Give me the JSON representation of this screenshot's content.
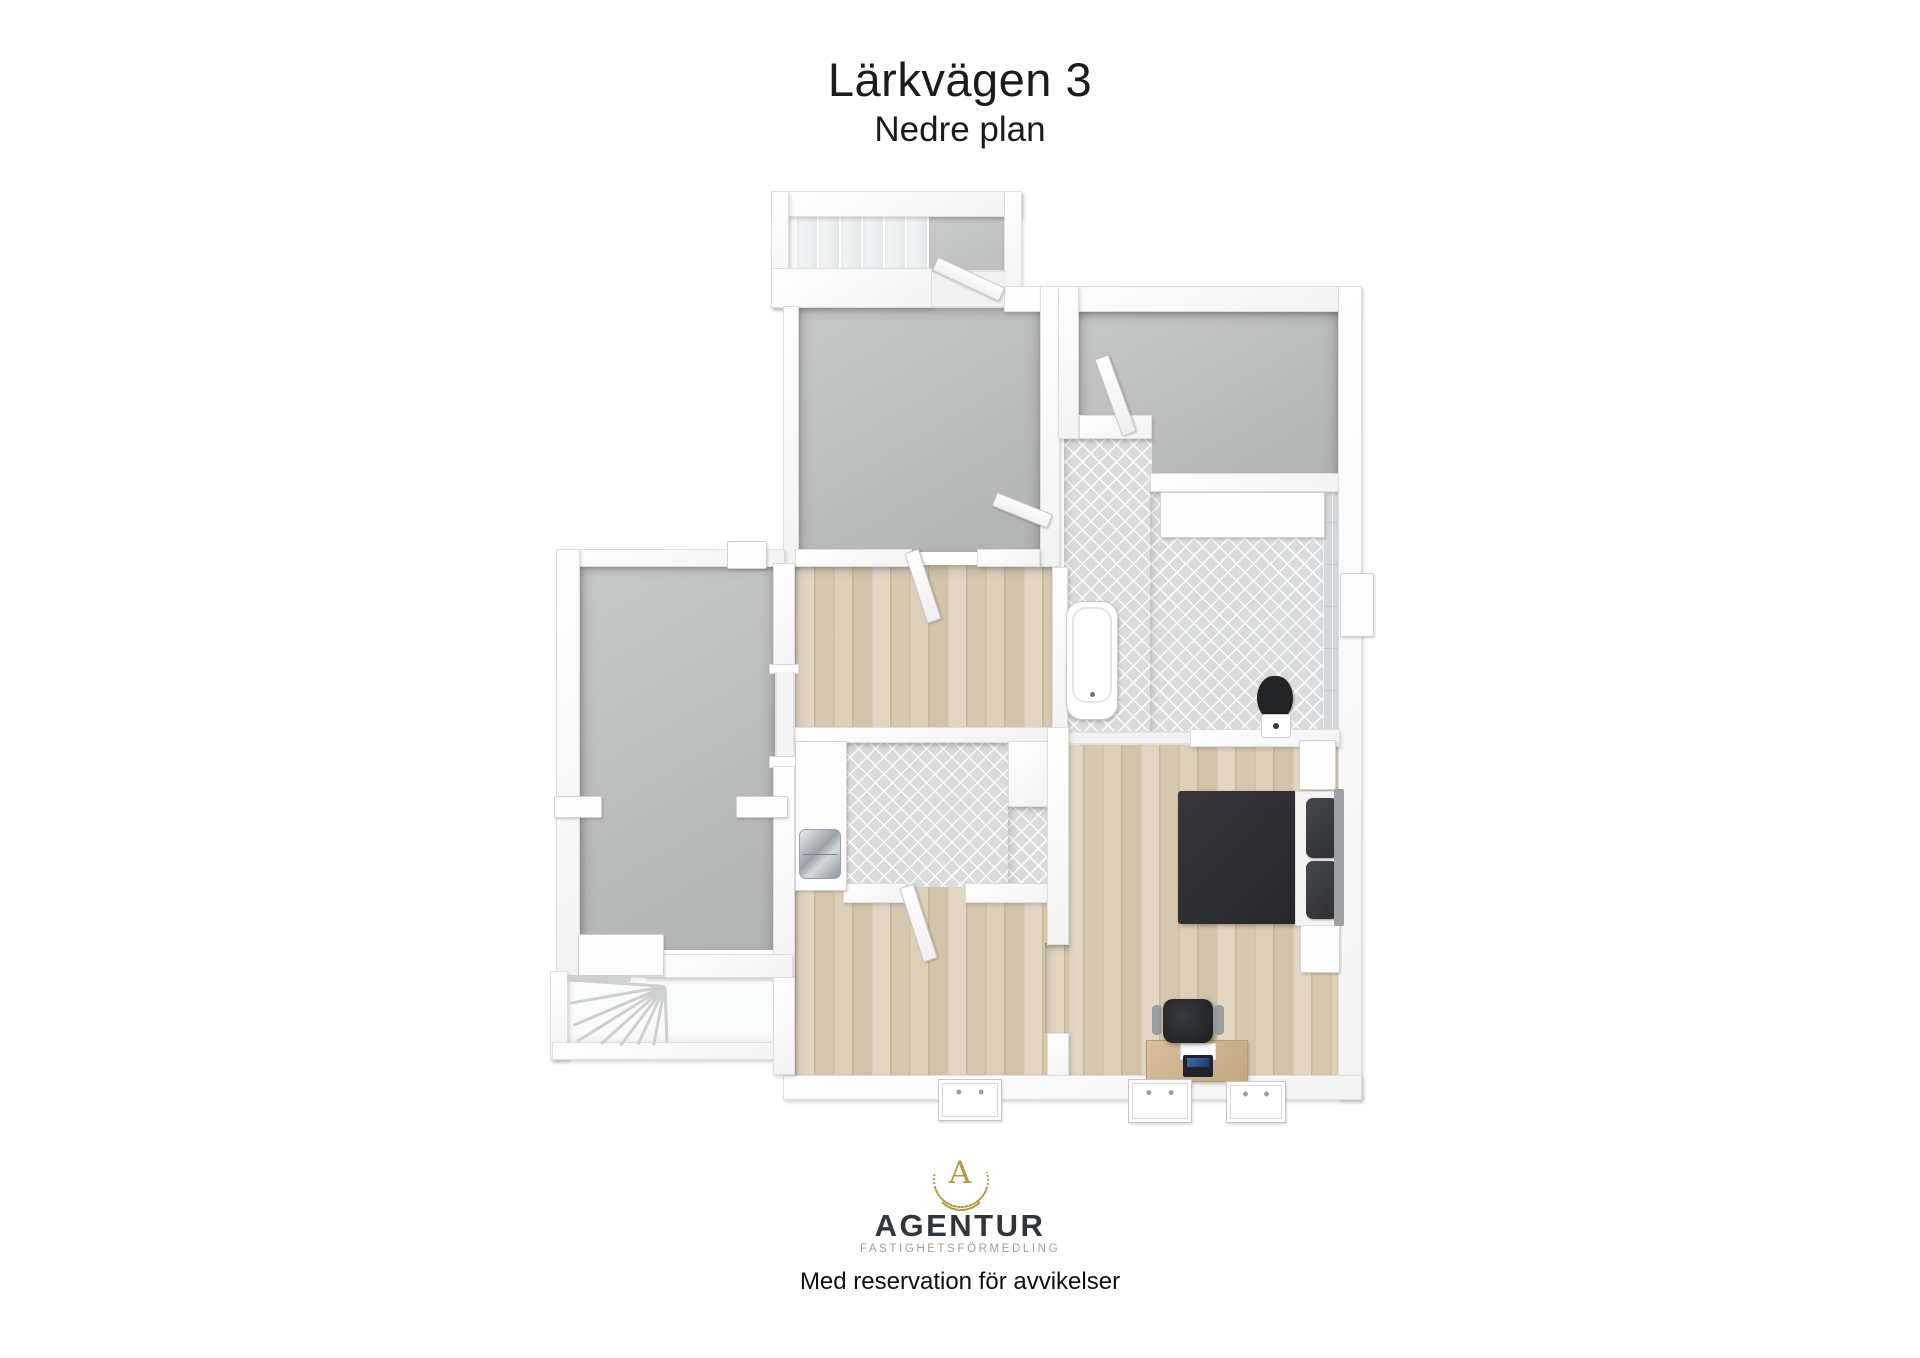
{
  "header": {
    "title": "Lärkvägen 3",
    "subtitle": "Nedre plan"
  },
  "footer": {
    "logo_monogram": "A",
    "brand": "AGENTUR",
    "brand_subtitle": "FASTIGHETSFÖRMEDLING",
    "disclaimer": "Med reservation för avvikelser"
  },
  "colors": {
    "accent_gold": "#b6983f",
    "wall_white": "#ffffff",
    "floor_gray": "#b9bbba",
    "floor_wood": "#dbceb6",
    "floor_tile": "#d9dbdd",
    "furniture_dark": "#2c2d2f",
    "text_dark": "#1b1b1b"
  },
  "plan": {
    "label": "3D floor plan, lower level",
    "elements": [
      {
        "n": "stairwell-top-floor",
        "t": "stairwell",
        "x": 787,
        "y": 205,
        "w": 143,
        "h": 70
      },
      {
        "n": "stair-landing-floor",
        "t": "floor-gray2",
        "x": 928,
        "y": 213,
        "w": 80,
        "h": 62
      },
      {
        "n": "room-top-middle-floor",
        "t": "floor-gray",
        "x": 797,
        "y": 306,
        "w": 243,
        "h": 246
      },
      {
        "n": "room-top-right-floor",
        "t": "floor-gray",
        "x": 1077,
        "y": 311,
        "w": 261,
        "h": 166
      },
      {
        "n": "bathroom-lobe-floor",
        "t": "floor-tile",
        "x": 1064,
        "y": 437,
        "w": 88,
        "h": 296
      },
      {
        "n": "bathroom-main-floor",
        "t": "floor-tile",
        "x": 1150,
        "y": 490,
        "w": 173,
        "h": 243
      },
      {
        "n": "bathroom-wall-tiles",
        "t": "tile-wall",
        "x": 1323,
        "y": 490,
        "w": 17,
        "h": 243
      },
      {
        "n": "room-left-floor",
        "t": "floor-gray",
        "x": 580,
        "y": 563,
        "w": 195,
        "h": 387
      },
      {
        "n": "hallway-floor",
        "t": "floor-wood",
        "x": 795,
        "y": 565,
        "w": 257,
        "h": 165
      },
      {
        "n": "room-bottom-floor",
        "t": "floor-wood",
        "x": 795,
        "y": 730,
        "w": 254,
        "h": 345
      },
      {
        "n": "bedroom-floor",
        "t": "floor-wood",
        "x": 1064,
        "y": 733,
        "w": 276,
        "h": 342
      },
      {
        "n": "bedroom-doorway-floor",
        "t": "floor-wood",
        "x": 1045,
        "y": 943,
        "w": 24,
        "h": 90
      },
      {
        "n": "laundry-floor",
        "t": "floor-tile",
        "x": 843,
        "y": 741,
        "w": 167,
        "h": 146
      },
      {
        "n": "laundry-floor-ext",
        "t": "floor-tile",
        "x": 1008,
        "y": 805,
        "w": 44,
        "h": 82
      },
      {
        "n": "stairwell-bottom-floor",
        "t": "stairwell",
        "x": 564,
        "y": 973,
        "w": 226,
        "h": 70
      },
      {
        "n": "stair-tread",
        "t": "tread-v",
        "x": 797,
        "y": 215,
        "w": 22,
        "h": 54
      },
      {
        "n": "stair-tread",
        "t": "tread-v",
        "x": 819,
        "y": 215,
        "w": 22,
        "h": 54
      },
      {
        "n": "stair-tread",
        "t": "tread-v",
        "x": 841,
        "y": 215,
        "w": 22,
        "h": 54
      },
      {
        "n": "stair-tread",
        "t": "tread-v",
        "x": 863,
        "y": 215,
        "w": 22,
        "h": 54
      },
      {
        "n": "stair-tread",
        "t": "tread-v",
        "x": 885,
        "y": 215,
        "w": 22,
        "h": 54
      },
      {
        "n": "stair-tread",
        "t": "tread-v",
        "x": 907,
        "y": 215,
        "w": 22,
        "h": 54
      },
      {
        "n": "wall-stairwell-top",
        "t": "wall",
        "x": 771,
        "y": 191,
        "w": 251,
        "h": 26
      },
      {
        "n": "wall-stairwell-left",
        "t": "wall",
        "x": 771,
        "y": 191,
        "w": 18,
        "h": 117
      },
      {
        "n": "wall-stairwell-right",
        "t": "wall",
        "x": 1004,
        "y": 191,
        "w": 18,
        "h": 111
      },
      {
        "n": "wall-stairwell-bottom",
        "t": "wall",
        "x": 771,
        "y": 268,
        "w": 161,
        "h": 40
      },
      {
        "n": "threshold-stairs",
        "t": "threshold",
        "x": 932,
        "y": 270,
        "w": 74,
        "h": 38
      },
      {
        "n": "wall-top-right-band",
        "t": "wall",
        "x": 1004,
        "y": 286,
        "w": 356,
        "h": 26
      },
      {
        "n": "wall-room-b-left",
        "t": "wall",
        "x": 783,
        "y": 306,
        "w": 16,
        "h": 261
      },
      {
        "n": "wall-room-b-right",
        "t": "wall",
        "x": 1040,
        "y": 286,
        "w": 20,
        "h": 281
      },
      {
        "n": "wall-room-c-left",
        "t": "wall",
        "x": 1058,
        "y": 286,
        "w": 21,
        "h": 153
      },
      {
        "n": "wall-room-c-notch",
        "t": "wall",
        "x": 1079,
        "y": 415,
        "w": 73,
        "h": 24
      },
      {
        "n": "wall-room-c-bottom",
        "t": "wall",
        "x": 1150,
        "y": 473,
        "w": 190,
        "h": 19
      },
      {
        "n": "wall-right-exterior",
        "t": "wall",
        "x": 1338,
        "y": 286,
        "w": 24,
        "h": 814
      },
      {
        "n": "wall-left-wing-top",
        "t": "wall",
        "x": 556,
        "y": 549,
        "w": 229,
        "h": 18
      },
      {
        "n": "wall-hall-top-left",
        "t": "wall",
        "x": 795,
        "y": 549,
        "w": 117,
        "h": 18
      },
      {
        "n": "wall-hall-top-right",
        "t": "wall",
        "x": 977,
        "y": 549,
        "w": 63,
        "h": 18
      },
      {
        "n": "wall-left-exterior",
        "t": "wall",
        "x": 556,
        "y": 549,
        "w": 24,
        "h": 428
      },
      {
        "n": "wall-left-room-right-upper",
        "t": "wall",
        "x": 773,
        "y": 563,
        "w": 22,
        "h": 109
      },
      {
        "n": "doorjamb",
        "t": "jamb",
        "x": 769,
        "y": 664,
        "w": 30,
        "h": 10
      },
      {
        "n": "doorway-left-room",
        "t": "threshold-v",
        "x": 775,
        "y": 672,
        "w": 20,
        "h": 86
      },
      {
        "n": "doorjamb",
        "t": "jamb",
        "x": 769,
        "y": 756,
        "w": 30,
        "h": 12
      },
      {
        "n": "wall-left-room-right-lower",
        "t": "wall",
        "x": 773,
        "y": 766,
        "w": 22,
        "h": 211
      },
      {
        "n": "wall-hall-bath-divider",
        "t": "wall",
        "x": 1052,
        "y": 567,
        "w": 16,
        "h": 166
      },
      {
        "n": "wall-hall-bottom",
        "t": "wall",
        "x": 795,
        "y": 727,
        "w": 254,
        "h": 16
      },
      {
        "n": "wall-bath-bottom",
        "t": "wall",
        "x": 1190,
        "y": 729,
        "w": 150,
        "h": 18
      },
      {
        "n": "threshold-bath-bedroom",
        "t": "threshold",
        "x": 1064,
        "y": 731,
        "w": 126,
        "h": 14
      },
      {
        "n": "wall-laundry-bottom-left",
        "t": "wall",
        "x": 843,
        "y": 883,
        "w": 64,
        "h": 20
      },
      {
        "n": "wall-laundry-bottom-right",
        "t": "wall",
        "x": 965,
        "y": 883,
        "w": 87,
        "h": 20
      },
      {
        "n": "wall-laundry-notch",
        "t": "wall",
        "x": 1008,
        "y": 741,
        "w": 44,
        "h": 66
      },
      {
        "n": "wall-bedroom-divider-upper",
        "t": "wall",
        "x": 1047,
        "y": 727,
        "w": 22,
        "h": 218
      },
      {
        "n": "wall-bedroom-divider-stub",
        "t": "wall",
        "x": 1047,
        "y": 1033,
        "w": 22,
        "h": 44
      },
      {
        "n": "wall-bottom-exterior",
        "t": "wall",
        "x": 783,
        "y": 1075,
        "w": 579,
        "h": 25
      },
      {
        "n": "wall-left-room-bottom",
        "t": "wall",
        "x": 645,
        "y": 954,
        "w": 148,
        "h": 24
      },
      {
        "n": "stair-platform",
        "t": "white-fix",
        "x": 578,
        "y": 934,
        "w": 84,
        "h": 40
      },
      {
        "n": "wall-stairs-bottom-left",
        "t": "wall",
        "x": 550,
        "y": 971,
        "w": 18,
        "h": 89
      },
      {
        "n": "wall-stairs-bottom",
        "t": "wall",
        "x": 552,
        "y": 1042,
        "w": 240,
        "h": 18
      },
      {
        "n": "wall-stairs-bottom-right",
        "t": "wall",
        "x": 773,
        "y": 977,
        "w": 22,
        "h": 98
      },
      {
        "n": "stair-edge",
        "t": "stair-line",
        "x": 567,
        "y": 975,
        "w": 64,
        "h": 7
      },
      {
        "n": "stair-line",
        "t": "stair-line",
        "x": 665,
        "y": 985,
        "w": 95,
        "h": 3,
        "rot": 184,
        "org": "left center"
      },
      {
        "n": "stair-line",
        "t": "stair-line",
        "x": 665,
        "y": 985,
        "w": 97,
        "h": 3,
        "rot": 170,
        "org": "left center"
      },
      {
        "n": "stair-line",
        "t": "stair-line",
        "x": 665,
        "y": 985,
        "w": 100,
        "h": 3,
        "rot": 157,
        "org": "left center"
      },
      {
        "n": "stair-line",
        "t": "stair-line",
        "x": 665,
        "y": 985,
        "w": 104,
        "h": 3,
        "rot": 148,
        "org": "left center"
      },
      {
        "n": "stair-line",
        "t": "stair-line",
        "x": 665,
        "y": 985,
        "w": 86,
        "h": 3,
        "rot": 138,
        "org": "left center"
      },
      {
        "n": "stair-line",
        "t": "stair-line",
        "x": 665,
        "y": 985,
        "w": 74,
        "h": 3,
        "rot": 127,
        "org": "left center"
      },
      {
        "n": "stair-line",
        "t": "stair-line",
        "x": 665,
        "y": 985,
        "w": 64,
        "h": 3,
        "rot": 115,
        "org": "left center"
      },
      {
        "n": "stair-line",
        "t": "stair-line",
        "x": 665,
        "y": 985,
        "w": 60,
        "h": 3,
        "rot": 101,
        "org": "left center"
      },
      {
        "n": "stair-line",
        "t": "stair-line",
        "x": 665,
        "y": 985,
        "w": 57,
        "h": 3,
        "rot": 88,
        "org": "left center"
      },
      {
        "n": "door-stairs",
        "t": "door",
        "x": 935,
        "y": 256,
        "w": 72,
        "h": 13,
        "rot": 25,
        "org": "left center"
      },
      {
        "n": "door-top-right-room",
        "t": "door",
        "x": 1122,
        "y": 352,
        "w": 13,
        "h": 80,
        "rot": -20,
        "org": "bottom center"
      },
      {
        "n": "door-hallway",
        "t": "door",
        "x": 904,
        "y": 551,
        "w": 13,
        "h": 72,
        "rot": -18,
        "org": "top center"
      },
      {
        "n": "door-room-b",
        "t": "door",
        "x": 990,
        "y": 514,
        "w": 58,
        "h": 13,
        "rot": 22,
        "org": "right center"
      },
      {
        "n": "door-laundry",
        "t": "door",
        "x": 899,
        "y": 886,
        "w": 13,
        "h": 76,
        "rot": -18,
        "org": "top center"
      },
      {
        "n": "bathroom-vanity",
        "t": "white-fix",
        "x": 1160,
        "y": 492,
        "w": 163,
        "h": 44
      },
      {
        "n": "bathroom-window-right",
        "t": "white-fix",
        "x": 1340,
        "y": 573,
        "w": 32,
        "h": 62
      },
      {
        "n": "bathtub",
        "t": "tub",
        "x": 1066,
        "y": 601,
        "w": 50,
        "h": 117
      },
      {
        "n": "toilet-lid",
        "t": "toilet-lid",
        "x": 1257,
        "y": 676,
        "w": 36,
        "h": 44
      },
      {
        "n": "toilet-base",
        "t": "toilet-base",
        "x": 1261,
        "y": 714,
        "w": 28,
        "h": 22
      },
      {
        "n": "laundry-counter",
        "t": "white-fix",
        "x": 795,
        "y": 741,
        "w": 50,
        "h": 148
      },
      {
        "n": "laundry-sink",
        "t": "sink",
        "x": 799,
        "y": 829,
        "w": 40,
        "h": 48
      },
      {
        "n": "radiator-left-wall",
        "t": "white-fix",
        "x": 554,
        "y": 796,
        "w": 46,
        "h": 20
      },
      {
        "n": "radiator-right-wall",
        "t": "white-fix",
        "x": 736,
        "y": 796,
        "w": 50,
        "h": 20
      },
      {
        "n": "wall-cabinet",
        "t": "white-fix",
        "x": 727,
        "y": 541,
        "w": 38,
        "h": 26
      },
      {
        "n": "nightstand",
        "t": "white-fix",
        "x": 1299,
        "y": 740,
        "w": 35,
        "h": 48
      },
      {
        "n": "nightstand",
        "t": "white-fix",
        "x": 1300,
        "y": 921,
        "w": 38,
        "h": 50
      },
      {
        "n": "bed-duvet",
        "t": "bed-duvet",
        "x": 1178,
        "y": 791,
        "w": 120,
        "h": 133
      },
      {
        "n": "bed-sheet",
        "t": "bed-sheet",
        "x": 1295,
        "y": 791,
        "w": 47,
        "h": 133
      },
      {
        "n": "bed-pillow",
        "t": "pillow-dark",
        "x": 1306,
        "y": 798,
        "w": 32,
        "h": 60
      },
      {
        "n": "bed-pillow",
        "t": "pillow-dark",
        "x": 1306,
        "y": 861,
        "w": 32,
        "h": 58
      },
      {
        "n": "bed-headboard",
        "t": "headboard",
        "x": 1334,
        "y": 789,
        "w": 10,
        "h": 137
      },
      {
        "n": "desk",
        "t": "desk",
        "x": 1146,
        "y": 1040,
        "w": 100,
        "h": 40
      },
      {
        "n": "desk-paper",
        "t": "paper",
        "x": 1180,
        "y": 1043,
        "w": 34,
        "h": 15
      },
      {
        "n": "laptop",
        "t": "laptop",
        "x": 1183,
        "y": 1055,
        "w": 30,
        "h": 22
      },
      {
        "n": "office-chair",
        "t": "chair",
        "x": 1163,
        "y": 999,
        "w": 50,
        "h": 44
      },
      {
        "n": "chair-armrest",
        "t": "chair-arm",
        "x": 1152,
        "y": 1005,
        "w": 10,
        "h": 30
      },
      {
        "n": "chair-armrest",
        "t": "chair-arm",
        "x": 1214,
        "y": 1005,
        "w": 10,
        "h": 30
      },
      {
        "n": "window",
        "t": "window",
        "x": 938,
        "y": 1079,
        "w": 62,
        "h": 40
      },
      {
        "n": "window",
        "t": "window",
        "x": 1128,
        "y": 1079,
        "w": 62,
        "h": 42
      },
      {
        "n": "window",
        "t": "window",
        "x": 1226,
        "y": 1081,
        "w": 58,
        "h": 40
      }
    ]
  }
}
